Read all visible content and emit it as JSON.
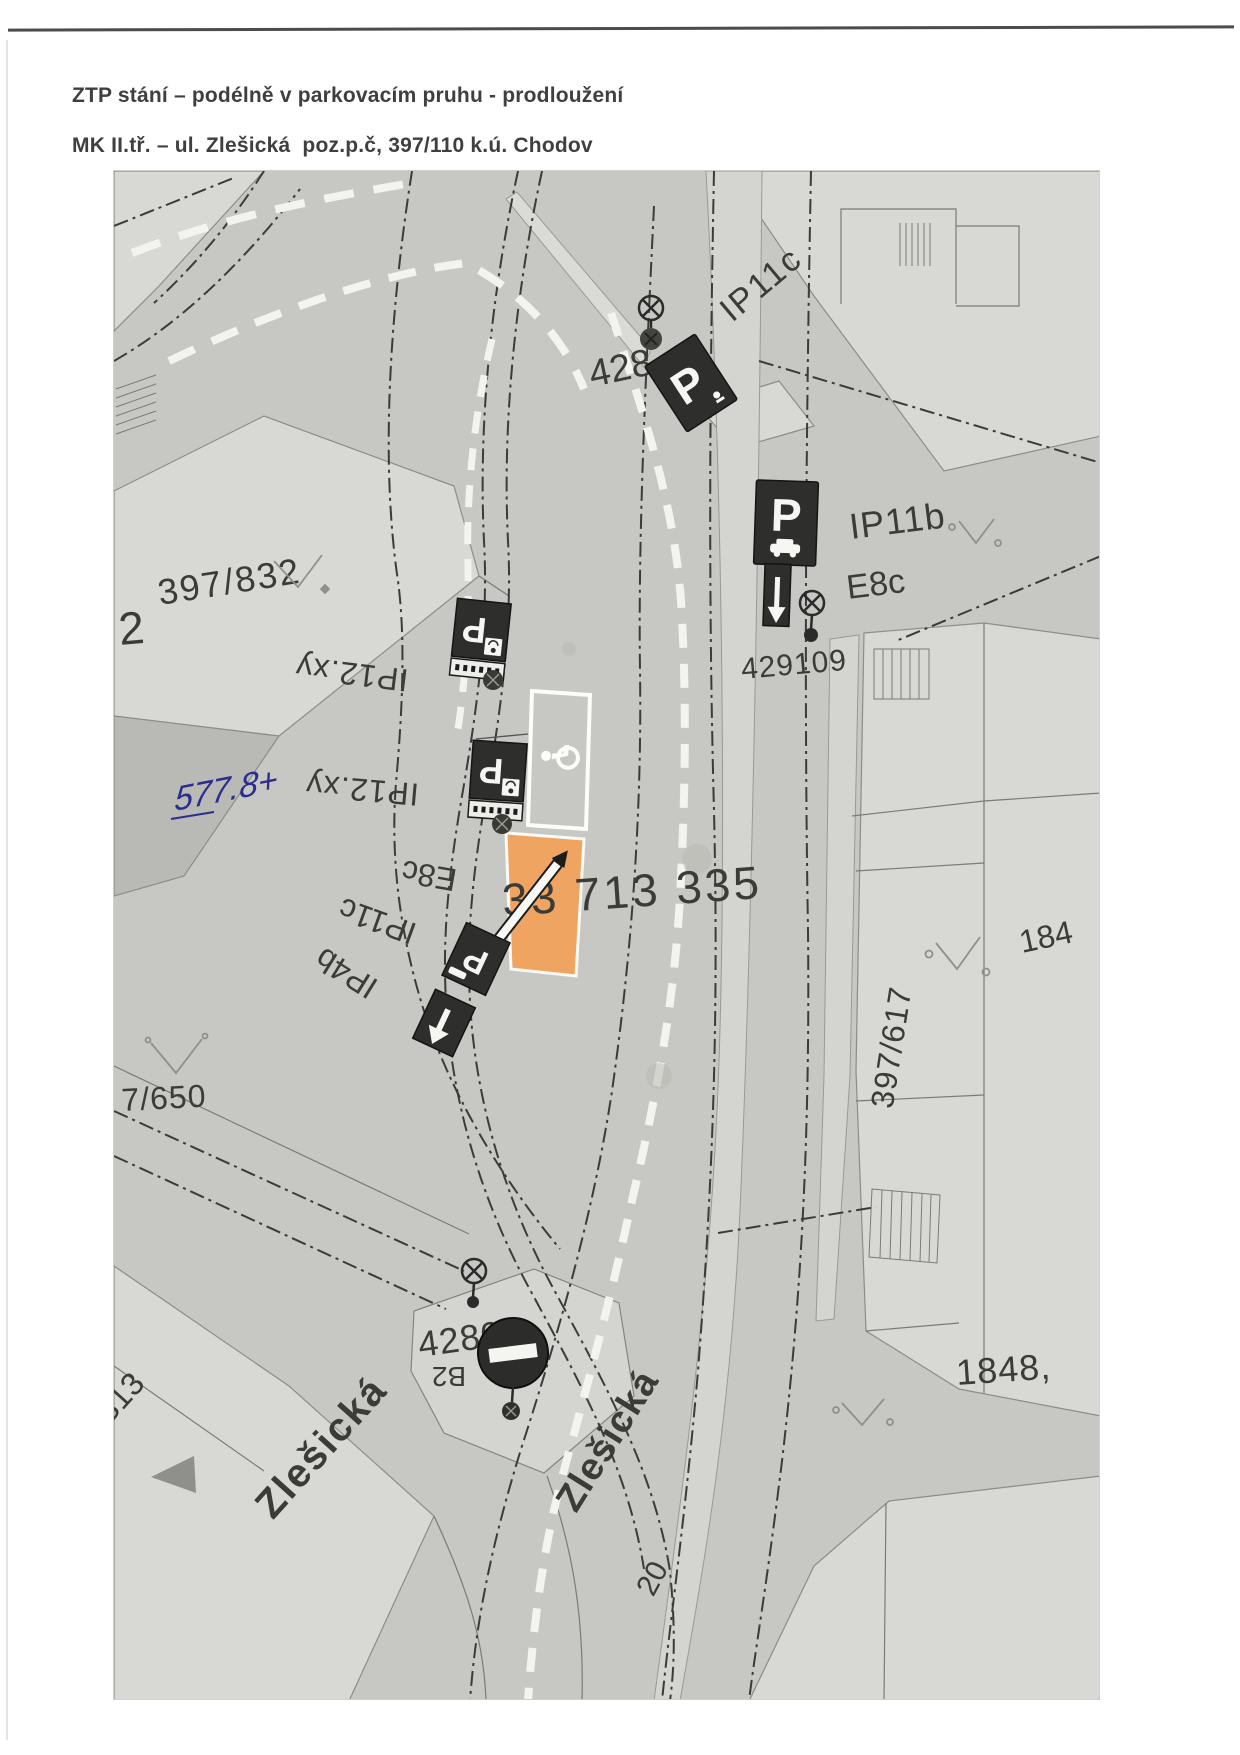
{
  "page": {
    "title_line1": "ZTP stání – podélně v parkovacím pruhu - prodloužení",
    "title_line2": "MK II.tř. – ul. Zlešická  poz.p.č, 397/110 k.ú. Chodov"
  },
  "map": {
    "colors": {
      "highlight_orange": "#F2A45C",
      "road_gray": "#C7C8C4",
      "parcel_light": "#D8D9D5",
      "sign_dark": "#2E2E2C",
      "ink": "#3B3B37",
      "handwriting_blue": "#2B2E8C"
    },
    "parcels": {
      "n397_832": "397/832",
      "n2": "2",
      "n7_650": "7/650",
      "n397_617": "397/617",
      "n184": "184",
      "n1848": "1848,",
      "n429109": "429109",
      "n428": "428",
      "n4280": "4280",
      "n33713335": "33 713 335",
      "n20": "20"
    },
    "signs": {
      "ip11c_top": "IP11c",
      "ip11b": "IP11b",
      "e8c_right": "E8c",
      "ip12xy_upper": "IP12.xy",
      "ip12xy_lower": "IP12.xy",
      "e8c_arc": "E8c",
      "ip11c_arc": "IP11c",
      "ip4b_arc": "IP4b",
      "b2": "B2",
      "b13": "B13",
      "p_glyph": "P"
    },
    "streets": {
      "zlesicka_west": "Zlešická",
      "zlesicka_south": "Zlešická"
    },
    "handwriting_note": "577.8+"
  }
}
